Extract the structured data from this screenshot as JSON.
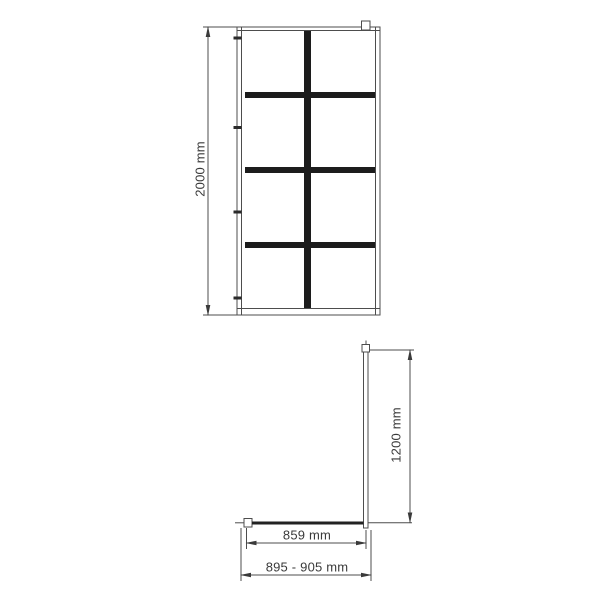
{
  "diagram": {
    "kind": "technical-dimension-drawing",
    "front_view": {
      "height_label": "2000 mm",
      "grid_columns": 2,
      "grid_rows": 4,
      "wall_fixing_count": 4
    },
    "plan_view": {
      "depth_label": "1200 mm",
      "glass_width_label": "859 mm",
      "total_width_label": "895 - 905 mm"
    },
    "colors": {
      "background": "#ffffff",
      "line": "#4d4d4d",
      "grid_bar": "#1c1c1c",
      "text": "#3a3a3a"
    }
  }
}
